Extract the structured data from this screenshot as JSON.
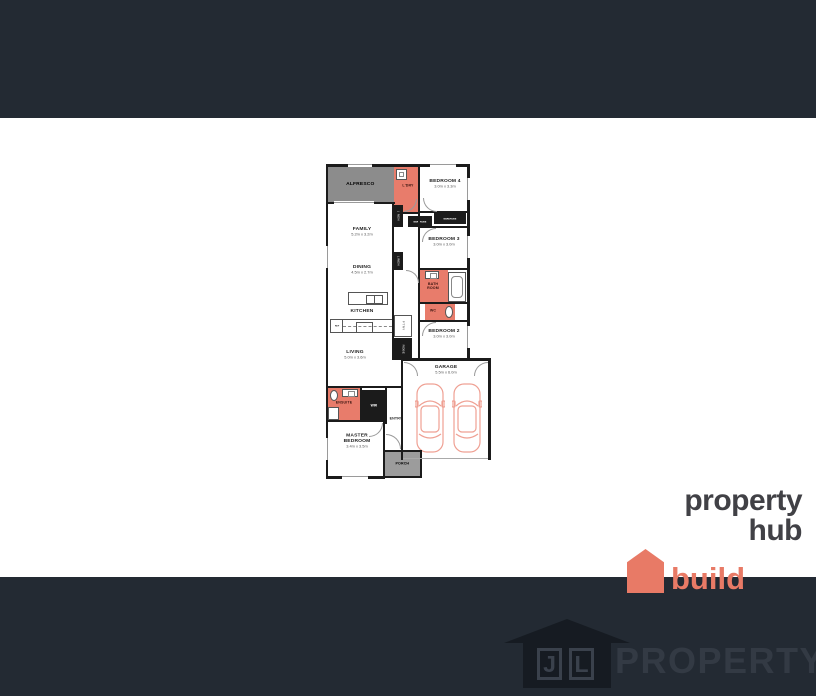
{
  "page": {
    "background": "#FFFFFF",
    "band_color": "#232A33"
  },
  "brand": {
    "title": "property hub",
    "subtitle": "build",
    "accent_color": "#E87A66",
    "title_color": "#414146"
  },
  "watermark": {
    "monogram_first": "J",
    "monogram_second": "L",
    "text": "PROPERTY",
    "text_color": "#333A44",
    "house_color": "#161B22"
  },
  "plan": {
    "colors": {
      "feature": "#E87C6B",
      "wall": "#1B1B1B",
      "alfresco": "#8C8C8C",
      "porch": "#9C9C9C",
      "car_outline": "#EFA093"
    },
    "rooms": [
      {
        "name": "ALFRESCO",
        "dims": ""
      },
      {
        "name": "L'DRY",
        "dims": ""
      },
      {
        "name": "BEDROOM 4",
        "dims": "3.0m x 3.3m"
      },
      {
        "name": "FAMILY",
        "dims": "5.2m x 3.2m"
      },
      {
        "name": "BEDROOM 3",
        "dims": "3.0m x 3.0m"
      },
      {
        "name": "DINING",
        "dims": "4.5m x 2.7m"
      },
      {
        "name": "BATH ROOM",
        "dims": ""
      },
      {
        "name": "WC",
        "dims": ""
      },
      {
        "name": "KITCHEN",
        "dims": ""
      },
      {
        "name": "BEDROOM 2",
        "dims": "3.0m x 3.0m"
      },
      {
        "name": "LIVING",
        "dims": "5.0m x 3.6m"
      },
      {
        "name": "GARAGE",
        "dims": "5.5m x 6.0m"
      },
      {
        "name": "ENSUITE",
        "dims": ""
      },
      {
        "name": "MASTER BEDROOM",
        "dims": "3.4m x 3.5m"
      },
      {
        "name": "PORCH",
        "dims": ""
      }
    ],
    "fixtures": {
      "linen1": "LINEN",
      "linen2": "LINEN",
      "wardrobe_left": "WARDROBE",
      "wardrobe_right": "WARDROBE",
      "pantry": "P'TRY",
      "robe": "ROBE",
      "wir": "WIR",
      "fridge": "REF",
      "entry": "ENTRY"
    }
  }
}
